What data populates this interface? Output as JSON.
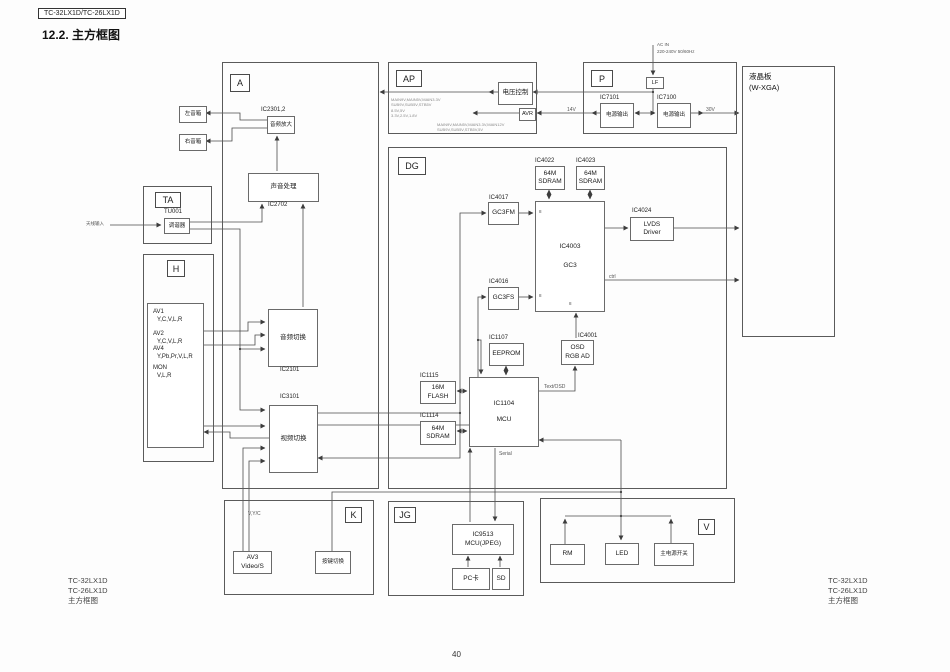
{
  "page": {
    "model_tag": "TC-32LX1D/TC-26LX1D",
    "heading": "12.2.  主方框图",
    "page_number": "40",
    "corner_left": {
      "l1": "TC-32LX1D",
      "l2": "TC-26LX1D",
      "l3": "主方框图"
    },
    "corner_right": {
      "l1": "TC-32LX1D",
      "l2": "TC-26LX1D",
      "l3": "主方框图"
    }
  },
  "sections": {
    "a": {
      "label": "A"
    },
    "ta": {
      "label": "TA"
    },
    "h": {
      "label": "H"
    },
    "ap": {
      "label": "AP"
    },
    "p": {
      "label": "P"
    },
    "dg": {
      "label": "DG"
    },
    "k": {
      "label": "K"
    },
    "jg": {
      "label": "JG"
    },
    "v": {
      "label": "V"
    },
    "panel": {
      "l1": "液晶板",
      "l2": "(W-XGA)"
    }
  },
  "blocks": {
    "speaker_left": "左音箱",
    "speaker_right": "右音箱",
    "amp": {
      "ref": "IC2301,2",
      "label": "音频放大"
    },
    "snd": {
      "ref": "IC2702",
      "label": "声音处理"
    },
    "tuner": {
      "ref": "TU001",
      "label": "调谐器"
    },
    "asw": {
      "ref": "IC2101",
      "label": "音频切换"
    },
    "vsw": {
      "ref": "IC3101",
      "label": "视频切换"
    },
    "av": {
      "l1": "AV1",
      "l2": "Y,C,V,L,R",
      "l3": "AV2",
      "l4": "Y,C,V,L,R",
      "l5": "AV4",
      "l6": "Y,Pb,Pr,V,L,R",
      "l7": "MON",
      "l8": "V,L,R"
    },
    "vc": "电压控制",
    "avr": "AVR",
    "lf": "LF",
    "ps1": {
      "ref": "IC7101",
      "label": "电源输出"
    },
    "ps2": {
      "ref": "IC7100",
      "label": "电源输出"
    },
    "sd1": {
      "ref": "IC4022",
      "l1": "64M",
      "l2": "SDRAM"
    },
    "sd2": {
      "ref": "IC4023",
      "l1": "64M",
      "l2": "SDRAM"
    },
    "fm": {
      "ref": "IC4017",
      "label": "GC3FM"
    },
    "fs": {
      "ref": "IC4016",
      "label": "GC3FS"
    },
    "gc3": {
      "ref": "IC4003",
      "label": "GC3"
    },
    "lvds": {
      "ref": "IC4024",
      "l1": "LVDS",
      "l2": "Driver"
    },
    "eep": {
      "ref": "IC1107",
      "label": "EEPROM"
    },
    "osd": {
      "ref": "IC4001",
      "l1": "OSD",
      "l2": "RGB AD"
    },
    "flash": {
      "ref": "IC1115",
      "l1": "16M",
      "l2": "FLASH"
    },
    "sdram": {
      "ref": "IC1114",
      "l1": "64M",
      "l2": "SDRAM"
    },
    "mcu": {
      "ref": "IC1104",
      "label": "MCU"
    },
    "jpeg": {
      "l1": "IC9513",
      "l2": "MCU(JPEG)"
    },
    "pccard": "PC卡",
    "sdcard": "SD",
    "av3": {
      "l1": "AV3",
      "l2": "Video/S"
    },
    "keysw": "按键切换",
    "rm": "RM",
    "led": "LED",
    "mainsw": "主电源开关"
  },
  "wire_labels": {
    "ant": "天线输入",
    "af": "AF",
    "lr_main": "L/R",
    "lr1": "L,R",
    "lr2": "L,R",
    "v": "V",
    "vyc": "V,Y/C",
    "serial": "Serial",
    "textosd": "Text/OSD",
    "v14": "14V",
    "v30": "30V",
    "ac1": "AC IN",
    "ac2": "220-240V 50/60Hz",
    "ctrl": "ctrl",
    "b8a": "8",
    "b8b": "8",
    "b8c": "8"
  },
  "ap_rails": {
    "r1": "MAIN9V,MAIN5V,MAIN3.3V",
    "r2": "SUB9V,SUB5V,STB5V",
    "r3": "8.5V,5V",
    "r4": "3.3V,2.5V,1.8V",
    "r5": "MAIN9V,MAIN5V,MAIN3.3V,MAIN12V",
    "r6": "SUB9V,SUB5V,STB5V,5V"
  }
}
